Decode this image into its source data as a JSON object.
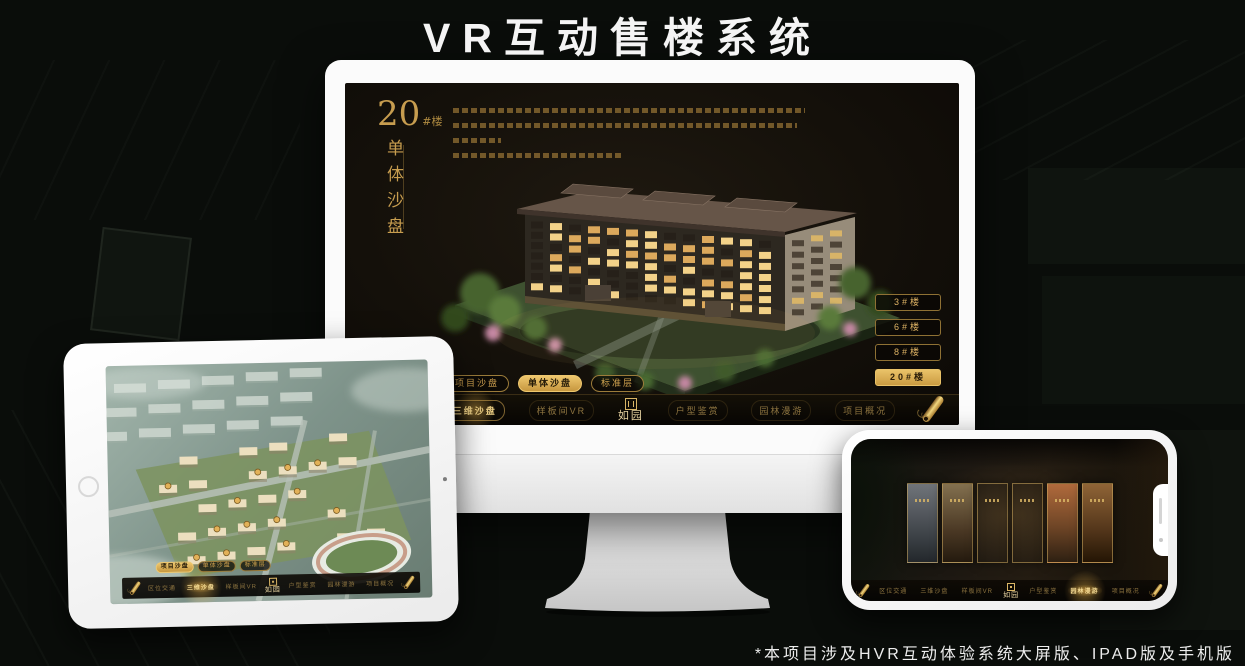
{
  "page": {
    "title": "VR互动售楼系统",
    "footnote": "*本项目涉及HVR互动体验系统大屏版、IPAD版及手机版"
  },
  "colors": {
    "gold": "#cfa14f",
    "gold_bright": "#ecc772",
    "background": "#0a0d0a",
    "screen_background": "#16110b"
  },
  "app": {
    "brand": "如园",
    "nav_items": [
      "区位交通",
      "三维沙盘",
      "样板间VR",
      "户型鉴赏",
      "园林漫游",
      "项目概况"
    ],
    "view_tabs": [
      "项目沙盘",
      "单体沙盘",
      "标准层"
    ]
  },
  "monitor": {
    "headline": {
      "number": "20",
      "unit": "#楼",
      "subtitle_vertical": "单体沙盘"
    },
    "floor_buttons": [
      "3#楼",
      "6#楼",
      "8#楼",
      "20#楼"
    ],
    "selected_floor": "20#楼",
    "selected_tab": "单体沙盘",
    "selected_nav": "三维沙盘"
  },
  "tablet": {
    "selected_tab": "项目沙盘",
    "selected_nav": "三维沙盘"
  },
  "phone": {
    "selected_nav": "园林漫游",
    "panel_count": 6
  },
  "icons": {
    "nav_scroll": "scroll-icon",
    "brand_seal": "seal-icon",
    "tablet_home": "home-button",
    "tablet_camera": "camera-dot"
  }
}
